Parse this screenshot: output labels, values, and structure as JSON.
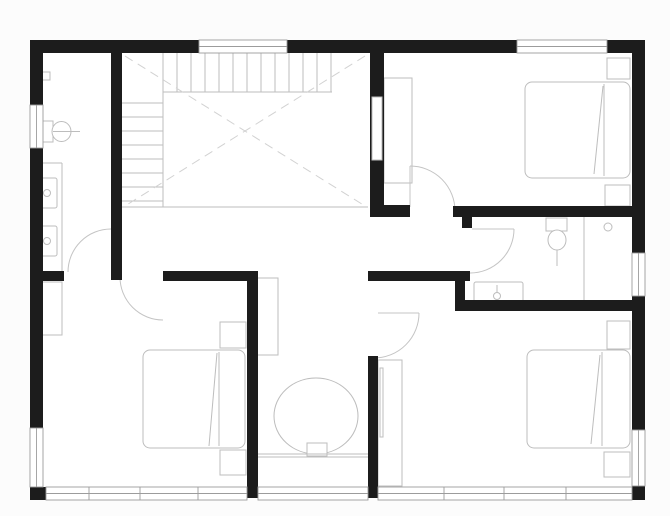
{
  "meta": {
    "title": "architectural-floor-plan",
    "canvas_w": 670,
    "canvas_h": 516
  },
  "colors": {
    "page_bg": "#fcfcfc",
    "floor": "#ffffff",
    "wall": "#1c1c1c",
    "window_frame": "#9c9c9c",
    "fixture_line": "#bdbdbd",
    "door_line": "#c4c4c4",
    "void_dash": "#d2d2d2"
  },
  "plan": {
    "walls": [
      {
        "n": "wall-top-left",
        "r": [
          30,
          40,
          169,
          13
        ]
      },
      {
        "n": "wall-top-mid",
        "r": [
          287,
          40,
          230,
          13
        ]
      },
      {
        "n": "wall-top-right",
        "r": [
          607,
          40,
          38,
          13
        ]
      },
      {
        "n": "wall-left-upper",
        "r": [
          30,
          53,
          13,
          52
        ]
      },
      {
        "n": "wall-left-main",
        "r": [
          30,
          148,
          13,
          280
        ]
      },
      {
        "n": "wall-corner-bottom-left",
        "r": [
          30,
          487,
          16,
          13
        ]
      },
      {
        "n": "wall-right-upper",
        "r": [
          632,
          53,
          13,
          200
        ]
      },
      {
        "n": "wall-right-mid",
        "r": [
          632,
          296,
          13,
          134
        ]
      },
      {
        "n": "wall-corner-bottom-right",
        "r": [
          632,
          486,
          13,
          14
        ]
      },
      {
        "n": "wall-bathroom1-east",
        "r": [
          111,
          53,
          11,
          227
        ]
      },
      {
        "n": "wall-hall-west-stub",
        "r": [
          40,
          271,
          24,
          10
        ]
      },
      {
        "n": "wall-hall-south",
        "r": [
          163,
          271,
          90,
          10
        ]
      },
      {
        "n": "wall-mid-vertical",
        "r": [
          247,
          271,
          11,
          227
        ]
      },
      {
        "n": "wall-bedroom1-west",
        "r": [
          370,
          53,
          14,
          164
        ]
      },
      {
        "n": "wall-bedroom1-south",
        "r": [
          370,
          205,
          40,
          12
        ]
      },
      {
        "n": "wall-bathroom2-north",
        "r": [
          453,
          206,
          179,
          11
        ]
      },
      {
        "n": "wall-bathroom2-door-stub",
        "r": [
          462,
          217,
          10,
          11
        ]
      },
      {
        "n": "wall-hall-east",
        "r": [
          368,
          271,
          102,
          10
        ]
      },
      {
        "n": "wall-bathroom2-west",
        "r": [
          455,
          271,
          10,
          40
        ]
      },
      {
        "n": "wall-bathroom2-south",
        "r": [
          455,
          300,
          177,
          11
        ]
      },
      {
        "n": "wall-bedroom3-west",
        "r": [
          368,
          356,
          10,
          142
        ]
      }
    ],
    "wall_slots": [
      {
        "n": "closet-pocket-slot",
        "r": [
          372,
          97,
          10,
          63
        ]
      }
    ],
    "windows": [
      {
        "n": "window-top-stairwell",
        "r": [
          199,
          40,
          88,
          13
        ],
        "dir": "h",
        "m": []
      },
      {
        "n": "window-top-bedroom1",
        "r": [
          517,
          40,
          90,
          13
        ],
        "dir": "h",
        "m": []
      },
      {
        "n": "window-left-bathroom1",
        "r": [
          30,
          105,
          13,
          43
        ],
        "dir": "v",
        "m": []
      },
      {
        "n": "window-left-bedroom2",
        "r": [
          30,
          428,
          13,
          59
        ],
        "dir": "v",
        "m": []
      },
      {
        "n": "window-right-bathroom2",
        "r": [
          632,
          253,
          13,
          43
        ],
        "dir": "v",
        "m": []
      },
      {
        "n": "window-right-bedroom3",
        "r": [
          632,
          430,
          13,
          56
        ],
        "dir": "v",
        "m": []
      },
      {
        "n": "window-bottom-bedroom2",
        "r": [
          46,
          487,
          201,
          13
        ],
        "dir": "h",
        "m": [
          89,
          140,
          198
        ]
      },
      {
        "n": "window-bottom-nook",
        "r": [
          258,
          487,
          110,
          13
        ],
        "dir": "h",
        "m": []
      },
      {
        "n": "window-bottom-bedroom3",
        "r": [
          378,
          487,
          254,
          13
        ],
        "dir": "h",
        "m": [
          444,
          504,
          566
        ]
      }
    ],
    "stairs": {
      "treads_vertical": {
        "x": [
          163,
          177,
          191,
          205,
          219,
          233,
          247,
          261,
          275,
          289,
          303,
          317,
          331
        ],
        "y1": 53,
        "y2": 92
      },
      "treads_horizontal": {
        "y": [
          103,
          117,
          131,
          145,
          159,
          173,
          187,
          201
        ],
        "x1": 122,
        "x2": 163
      },
      "edge_lines": [
        [
          163,
          92,
          332,
          92
        ],
        [
          163,
          53,
          163,
          207
        ],
        [
          122,
          207,
          368,
          207
        ]
      ],
      "void_cross": [
        [
          125,
          56,
          365,
          206
        ],
        [
          365,
          56,
          125,
          206
        ]
      ]
    },
    "doors": [
      {
        "n": "door-bathroom1",
        "leaf": null,
        "arc": "M 68 272 A 43 43 0 0 1 111 229"
      },
      {
        "n": "door-bedroom2",
        "leaf": null,
        "arc": "M 120 277 A 43 43 0 0 0 163 320"
      },
      {
        "n": "door-bedroom1",
        "leaf": [
          410,
          166,
          410,
          207
        ],
        "arc": "M 410 166 A 45 45 0 0 1 455 211"
      },
      {
        "n": "door-bathroom2",
        "leaf": [
          472,
          229,
          514,
          229
        ],
        "arc": "M 514 229 A 44 44 0 0 1 470 273"
      },
      {
        "n": "door-bedroom3",
        "leaf": [
          378,
          313,
          419,
          313
        ],
        "arc": "M 419 313 A 45 45 0 0 1 374 358"
      }
    ],
    "fixtures": [
      {
        "n": "toilet1-tank",
        "s": "rect",
        "p": [
          37,
          121,
          16,
          21
        ]
      },
      {
        "n": "toilet1-bowl",
        "s": "ellipse",
        "p": [
          61.5,
          131.5,
          9.5,
          10
        ]
      },
      {
        "n": "toilet1-centerline",
        "s": "line",
        "p": [
          53,
          131.5,
          80,
          131.5
        ]
      },
      {
        "n": "wall-fixture",
        "s": "rect",
        "p": [
          42,
          72,
          8,
          8
        ]
      },
      {
        "n": "wall-fixture-stem",
        "s": "line",
        "p": [
          36,
          76,
          42,
          76
        ]
      },
      {
        "n": "counter-top-edge",
        "s": "line",
        "p": [
          43,
          163,
          62,
          163
        ]
      },
      {
        "n": "counter-front-edge",
        "s": "line",
        "p": [
          62,
          163,
          62,
          271
        ]
      },
      {
        "n": "sink1",
        "s": "rect",
        "p": [
          38,
          178,
          19,
          30
        ],
        "rx": 2
      },
      {
        "n": "sink1-basin",
        "s": "circle",
        "p": [
          47,
          193,
          3.5
        ]
      },
      {
        "n": "sink1-faucet",
        "s": "line",
        "p": [
          38,
          193,
          43.5,
          193
        ]
      },
      {
        "n": "sink2",
        "s": "rect",
        "p": [
          38,
          226,
          19,
          30
        ],
        "rx": 2
      },
      {
        "n": "sink2-basin",
        "s": "circle",
        "p": [
          47,
          241,
          3.5
        ]
      },
      {
        "n": "sink2-faucet",
        "s": "line",
        "p": [
          38,
          241,
          43.5,
          241
        ]
      },
      {
        "n": "toilet2-tank",
        "s": "rect",
        "p": [
          546,
          218,
          21,
          13
        ]
      },
      {
        "n": "toilet2-bowl",
        "s": "ellipse",
        "p": [
          557,
          240,
          9,
          10
        ]
      },
      {
        "n": "toilet2-centerline",
        "s": "line",
        "p": [
          557,
          250,
          557,
          266
        ]
      },
      {
        "n": "vanity",
        "s": "rect",
        "p": [
          474,
          282,
          49,
          21
        ],
        "rx": 2
      },
      {
        "n": "vanity-basin",
        "s": "circle",
        "p": [
          497,
          296,
          3.5
        ]
      },
      {
        "n": "vanity-spout",
        "s": "line",
        "p": [
          497,
          285,
          497,
          292.5
        ]
      },
      {
        "n": "shower-screen",
        "s": "line",
        "p": [
          584,
          217,
          584,
          300
        ]
      },
      {
        "n": "shower-drain",
        "s": "circle",
        "p": [
          608,
          227,
          4
        ]
      },
      {
        "n": "closet-bedroom1",
        "s": "rect",
        "p": [
          384,
          78,
          28,
          105
        ]
      },
      {
        "n": "bed1-mattress",
        "s": "rect",
        "p": [
          525,
          82,
          105,
          96
        ],
        "rx": 7
      },
      {
        "n": "bed1-blanket-edge",
        "s": "line",
        "p": [
          604,
          84,
          604,
          176
        ]
      },
      {
        "n": "bed1-fold",
        "s": "line",
        "p": [
          603,
          86,
          594,
          174
        ]
      },
      {
        "n": "nightstand1a",
        "s": "rect",
        "p": [
          607,
          58,
          23,
          21
        ]
      },
      {
        "n": "nightstand1b",
        "s": "rect",
        "p": [
          605,
          185,
          25,
          21
        ]
      },
      {
        "n": "wardrobe-bedroom3",
        "s": "rect",
        "p": [
          378,
          360,
          24,
          126
        ]
      },
      {
        "n": "wardrobe-bedroom3-rail",
        "s": "rect",
        "p": [
          380,
          368,
          3,
          69
        ]
      },
      {
        "n": "bed3-mattress",
        "s": "rect",
        "p": [
          527,
          350,
          103,
          98
        ],
        "rx": 7
      },
      {
        "n": "bed3-blanket-edge",
        "s": "line",
        "p": [
          602,
          352,
          602,
          446
        ]
      },
      {
        "n": "bed3-fold",
        "s": "line",
        "p": [
          600,
          355,
          591,
          444
        ]
      },
      {
        "n": "nightstand3a",
        "s": "rect",
        "p": [
          607,
          321,
          23,
          28
        ]
      },
      {
        "n": "nightstand3b",
        "s": "rect",
        "p": [
          604,
          452,
          26,
          25
        ]
      },
      {
        "n": "wardrobe-bedroom2",
        "s": "rect",
        "p": [
          36,
          282,
          26,
          53
        ]
      },
      {
        "n": "wardrobe-bedroom2-line",
        "s": "line",
        "p": [
          37,
          337,
          37,
          422
        ]
      },
      {
        "n": "bed2-mattress",
        "s": "rect",
        "p": [
          143,
          350,
          102,
          98
        ],
        "rx": 7
      },
      {
        "n": "bed2-blanket-edge",
        "s": "line",
        "p": [
          219,
          352,
          219,
          446
        ]
      },
      {
        "n": "bed2-fold",
        "s": "line",
        "p": [
          217,
          353,
          209,
          446
        ]
      },
      {
        "n": "nightstand2a",
        "s": "rect",
        "p": [
          220,
          322,
          26,
          26
        ]
      },
      {
        "n": "nightstand2b",
        "s": "rect",
        "p": [
          220,
          450,
          26,
          25
        ]
      },
      {
        "n": "closet-nook",
        "s": "rect",
        "p": [
          257,
          278,
          21,
          77
        ]
      },
      {
        "n": "round-table",
        "s": "ellipse",
        "p": [
          316,
          416,
          42,
          38
        ]
      },
      {
        "n": "seat",
        "s": "rect",
        "p": [
          307,
          443,
          20,
          13
        ]
      },
      {
        "n": "window-seat-edge-1",
        "s": "line",
        "p": [
          258,
          454,
          368,
          454
        ]
      },
      {
        "n": "window-seat-edge-2",
        "s": "line",
        "p": [
          258,
          457,
          368,
          457
        ]
      }
    ]
  }
}
